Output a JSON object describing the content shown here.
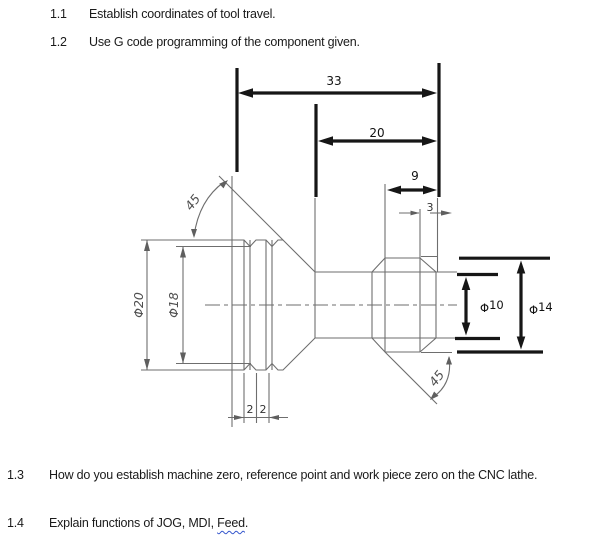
{
  "questions": {
    "q11": {
      "number": "1.1",
      "text": "Establish coordinates of tool travel."
    },
    "q12": {
      "number": "1.2",
      "text": "Use G code programming of the component given."
    },
    "q13": {
      "number": "1.3",
      "text": "How do you establish machine zero, reference point and work piece zero on the CNC lathe."
    },
    "q14": {
      "number": "1.4",
      "prefix": "Explain functions of JOG, MDI, ",
      "flagged_word": "Feed",
      "suffix": "."
    }
  },
  "drawing": {
    "dimensions": {
      "overall_length": "33",
      "mid_length": "20",
      "head_length": "9",
      "tip_length": "3",
      "groove_width_1": "2",
      "groove_width_2": "2",
      "major_diameter": "Φ20",
      "groove_diameter": "Φ18",
      "taper_angle": "45",
      "chamfer_angle": "45",
      "neck_diameter_symbol": "Φ",
      "neck_diameter_value": "10",
      "head_diameter_symbol": "Φ",
      "head_diameter_value": "14"
    },
    "colors": {
      "pencil_line": "#6e6e6e",
      "ink_line": "#161616",
      "grammar_underline": "#3355cc"
    }
  }
}
